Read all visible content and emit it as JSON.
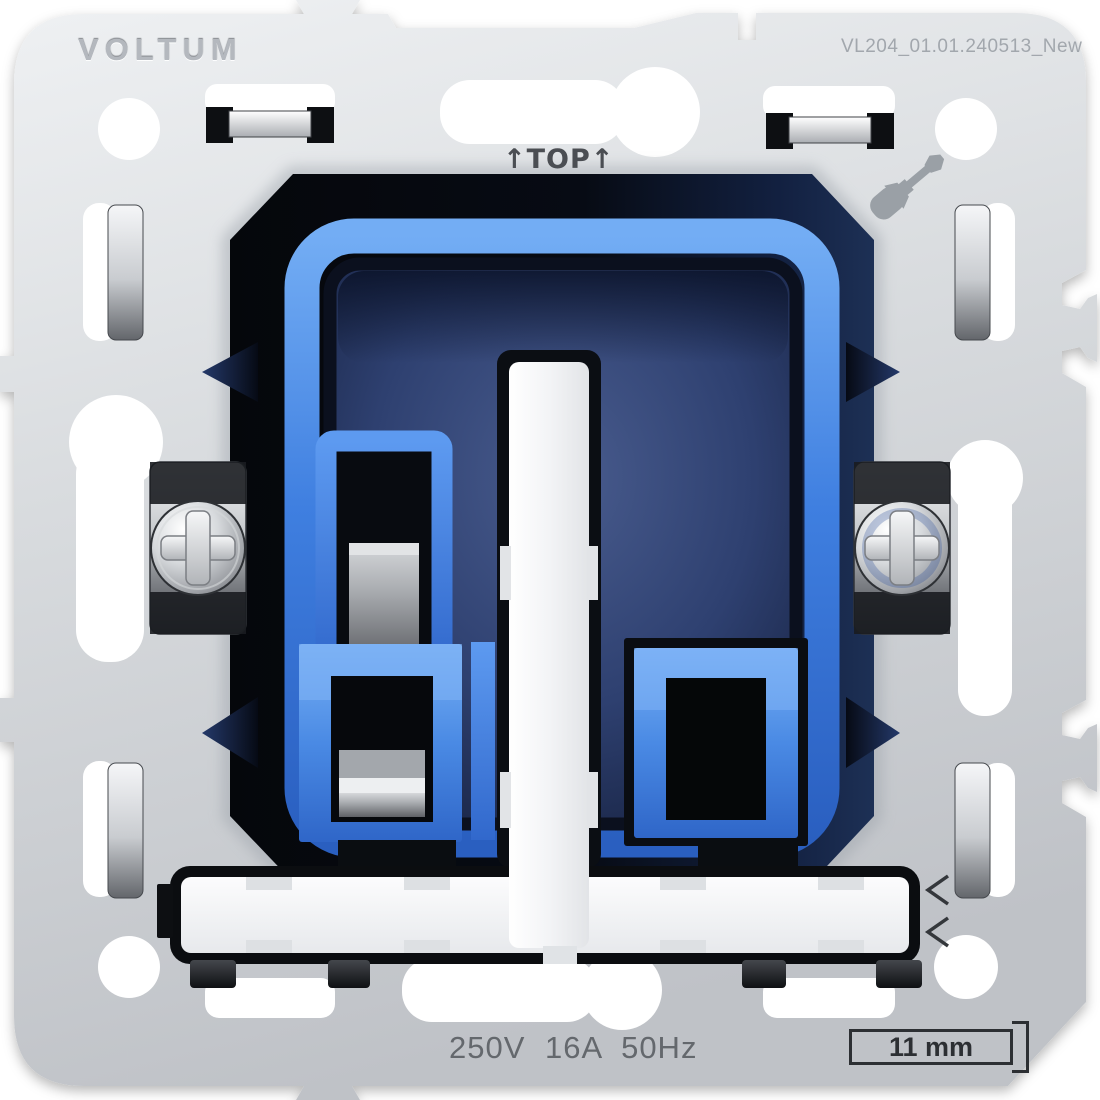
{
  "product": {
    "brand": "VOLTUM",
    "model_code": "VL204_01.01.240513_New",
    "orientation_label": "↑TOP↑",
    "electrical_rating": "250V 16A 50Hz",
    "depth_dimension": "11 mm"
  },
  "icons": {
    "screwdriver": "screwdriver-icon",
    "phillips_screw_left": "phillips-screw-icon",
    "phillips_screw_right": "phillips-screw-icon",
    "orientation_arrows": "up-arrow-glyphs"
  },
  "colors": {
    "plate_metal": "#d6d9dd",
    "module_blue": "#3f7fe0",
    "module_blue_light": "#7fb2f5",
    "recess_navy": "#2e4070",
    "outline_black": "#0a0d12",
    "text_gray": "#64686d",
    "engraving_gray": "#b4b8be",
    "chrome_light": "#f4f5f7"
  }
}
